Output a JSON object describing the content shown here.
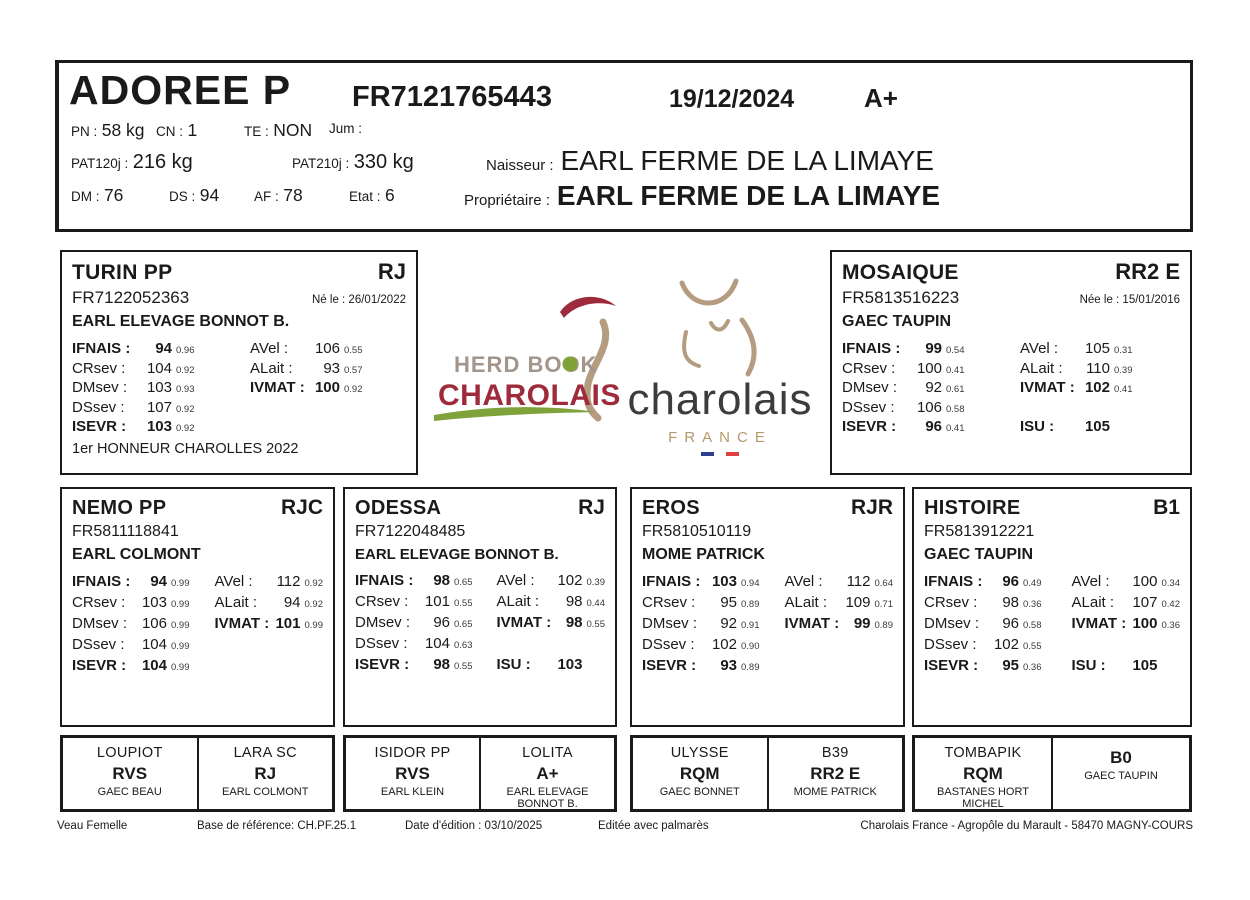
{
  "header": {
    "name": "ADOREE P",
    "id": "FR7121765443",
    "date": "19/12/2024",
    "grade": "A+",
    "pn_label": "PN :",
    "pn": "58 kg",
    "cn_label": "CN :",
    "cn": "1",
    "te_label": "TE :",
    "te": "NON",
    "jum_label": "Jum :",
    "pat120_label": "PAT120j :",
    "pat120": "216 kg",
    "pat210_label": "PAT210j :",
    "pat210": "330 kg",
    "naisseur_label": "Naisseur :",
    "naisseur": "EARL FERME DE LA LIMAYE",
    "dm_label": "DM :",
    "dm": "76",
    "ds_label": "DS :",
    "ds": "94",
    "af_label": "AF :",
    "af": "78",
    "etat_label": "Etat :",
    "etat": "6",
    "proprietaire_label": "Propriétaire :",
    "proprietaire": "EARL FERME DE LA LIMAYE"
  },
  "logos": {
    "herdbook_line1": "HERD BOOK",
    "herdbook_line2": "CHAROLAIS",
    "charolais": "charolais",
    "france": "FRANCE",
    "colors": {
      "darkred": "#9e2b3b",
      "green": "#7fa33a",
      "tan": "#b59c80",
      "taupe": "#a3958a",
      "gray": "#3c3c3c",
      "flag_blue": "#2f3f8f",
      "flag_red": "#e04040"
    }
  },
  "sire": {
    "name": "TURIN PP",
    "qual": "RJ",
    "id": "FR7122052363",
    "born": "Né le : 26/01/2022",
    "owner": "EARL ELEVAGE BONNOT B.",
    "left": [
      {
        "label": "IFNAIS :",
        "value": "94",
        "index": "0.96"
      },
      {
        "label": "CRsev :",
        "value": "104",
        "index": "0.92"
      },
      {
        "label": "DMsev :",
        "value": "103",
        "index": "0.93"
      },
      {
        "label": "DSsev :",
        "value": "107",
        "index": "0.92"
      },
      {
        "label": "ISEVR :",
        "value": "103",
        "index": "0.92"
      }
    ],
    "right": [
      {
        "label": "AVel :",
        "value": "106",
        "index": "0.55"
      },
      {
        "label": "ALait :",
        "value": "93",
        "index": "0.57"
      },
      {
        "label": "IVMAT :",
        "value": "100",
        "index": "0.92"
      }
    ],
    "note": "1er HONNEUR CHAROLLES 2022"
  },
  "dam": {
    "name": "MOSAIQUE",
    "qual": "RR2 E",
    "id": "FR5813516223",
    "born": "Née le : 15/01/2016",
    "owner": "GAEC TAUPIN",
    "left": [
      {
        "label": "IFNAIS :",
        "value": "99",
        "index": "0.54"
      },
      {
        "label": "CRsev :",
        "value": "100",
        "index": "0.41"
      },
      {
        "label": "DMsev :",
        "value": "92",
        "index": "0.61"
      },
      {
        "label": "DSsev :",
        "value": "106",
        "index": "0.58"
      },
      {
        "label": "ISEVR :",
        "value": "96",
        "index": "0.41"
      }
    ],
    "right": [
      {
        "label": "AVel :",
        "value": "105",
        "index": "0.31"
      },
      {
        "label": "ALait :",
        "value": "110",
        "index": "0.39"
      },
      {
        "label": "IVMAT :",
        "value": "102",
        "index": "0.41"
      }
    ],
    "isu_label": "ISU :",
    "isu": "105"
  },
  "grandparents": [
    {
      "name": "NEMO PP",
      "qual": "RJC",
      "id": "FR5811118841",
      "owner": "EARL COLMONT",
      "left": [
        {
          "label": "IFNAIS :",
          "value": "94",
          "index": "0.99"
        },
        {
          "label": "CRsev :",
          "value": "103",
          "index": "0.99"
        },
        {
          "label": "DMsev :",
          "value": "106",
          "index": "0.99"
        },
        {
          "label": "DSsev :",
          "value": "104",
          "index": "0.99"
        },
        {
          "label": "ISEVR :",
          "value": "104",
          "index": "0.99"
        }
      ],
      "right": [
        {
          "label": "AVel :",
          "value": "112",
          "index": "0.92"
        },
        {
          "label": "ALait :",
          "value": "94",
          "index": "0.92"
        },
        {
          "label": "IVMAT :",
          "value": "101",
          "index": "0.99"
        }
      ]
    },
    {
      "name": "ODESSA",
      "qual": "RJ",
      "id": "FR7122048485",
      "owner": "EARL ELEVAGE BONNOT B.",
      "left": [
        {
          "label": "IFNAIS :",
          "value": "98",
          "index": "0.65"
        },
        {
          "label": "CRsev :",
          "value": "101",
          "index": "0.55"
        },
        {
          "label": "DMsev :",
          "value": "96",
          "index": "0.65"
        },
        {
          "label": "DSsev :",
          "value": "104",
          "index": "0.63"
        },
        {
          "label": "ISEVR :",
          "value": "98",
          "index": "0.55"
        }
      ],
      "right": [
        {
          "label": "AVel :",
          "value": "102",
          "index": "0.39"
        },
        {
          "label": "ALait :",
          "value": "98",
          "index": "0.44"
        },
        {
          "label": "IVMAT :",
          "value": "98",
          "index": "0.55"
        }
      ],
      "isu_label": "ISU :",
      "isu": "103"
    },
    {
      "name": "EROS",
      "qual": "RJR",
      "id": "FR5810510119",
      "owner": "MOME PATRICK",
      "left": [
        {
          "label": "IFNAIS :",
          "value": "103",
          "index": "0.94"
        },
        {
          "label": "CRsev :",
          "value": "95",
          "index": "0.89"
        },
        {
          "label": "DMsev :",
          "value": "92",
          "index": "0.91"
        },
        {
          "label": "DSsev :",
          "value": "102",
          "index": "0.90"
        },
        {
          "label": "ISEVR :",
          "value": "93",
          "index": "0.89"
        }
      ],
      "right": [
        {
          "label": "AVel :",
          "value": "112",
          "index": "0.64"
        },
        {
          "label": "ALait :",
          "value": "109",
          "index": "0.71"
        },
        {
          "label": "IVMAT :",
          "value": "99",
          "index": "0.89"
        }
      ]
    },
    {
      "name": "HISTOIRE",
      "qual": "B1",
      "id": "FR5813912221",
      "owner": "GAEC TAUPIN",
      "left": [
        {
          "label": "IFNAIS :",
          "value": "96",
          "index": "0.49"
        },
        {
          "label": "CRsev :",
          "value": "98",
          "index": "0.36"
        },
        {
          "label": "DMsev :",
          "value": "96",
          "index": "0.58"
        },
        {
          "label": "DSsev :",
          "value": "102",
          "index": "0.55"
        },
        {
          "label": "ISEVR :",
          "value": "95",
          "index": "0.36"
        }
      ],
      "right": [
        {
          "label": "AVel :",
          "value": "100",
          "index": "0.34"
        },
        {
          "label": "ALait :",
          "value": "107",
          "index": "0.42"
        },
        {
          "label": "IVMAT :",
          "value": "100",
          "index": "0.36"
        }
      ],
      "isu_label": "ISU :",
      "isu": "105"
    }
  ],
  "greatgrandparents": [
    {
      "name": "LOUPIOT",
      "qual": "RVS",
      "owner": "GAEC BEAU"
    },
    {
      "name": "LARA SC",
      "qual": "RJ",
      "owner": "EARL COLMONT"
    },
    {
      "name": "ISIDOR PP",
      "qual": "RVS",
      "owner": "EARL KLEIN"
    },
    {
      "name": "LOLITA",
      "qual": "A+",
      "owner": "EARL ELEVAGE BONNOT B."
    },
    {
      "name": "ULYSSE",
      "qual": "RQM",
      "owner": "GAEC BONNET"
    },
    {
      "name": "B39",
      "qual": "RR2 E",
      "owner": "MOME PATRICK"
    },
    {
      "name": "TOMBAPIK",
      "qual": "RQM",
      "owner": "BASTANES HORT MICHEL"
    },
    {
      "name": "",
      "qual": "B0",
      "owner": "GAEC TAUPIN"
    }
  ],
  "footer": {
    "sex": "Veau Femelle",
    "base": "Base de référence: CH.PF.25.1",
    "edition": "Date d'édition : 03/10/2025",
    "palmares": "Editée avec palmarès",
    "address": "Charolais France - Agropôle du Marault - 58470 MAGNY-COURS"
  }
}
